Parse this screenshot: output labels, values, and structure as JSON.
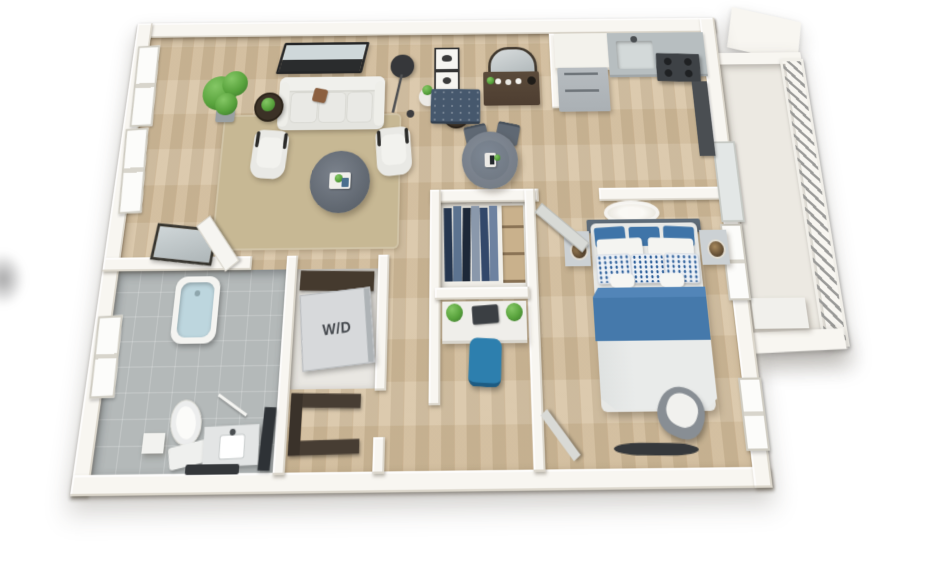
{
  "floorplan": {
    "type": "3d-apartment-floor-plan",
    "wd_label": "W/D",
    "colors": {
      "wall": "#f8f6f1",
      "wood": "#d6c1a0",
      "tile": "#b4b9b9",
      "rug": "#c7b894",
      "sofa": "#e8e8e4",
      "navy": "#46586d",
      "furnGray": "#6e7680",
      "bedBlue": "#4579ab",
      "pillowBlue": "#2d5f9a",
      "duvet": "#e9ebea",
      "stainless": "#aab0b4",
      "counter": "#b7bec0",
      "stove": "#3e4246",
      "green": "#58a23c",
      "greenDark": "#3f7d2e",
      "brownWood": "#4e3e31",
      "wdUnit": "#d7d9db",
      "wdText": "#43474c",
      "railSlat": "#9a9a98",
      "chairBlue": "#2d7fae",
      "doorDark": "#43484d",
      "water": "#bdd6de"
    }
  }
}
